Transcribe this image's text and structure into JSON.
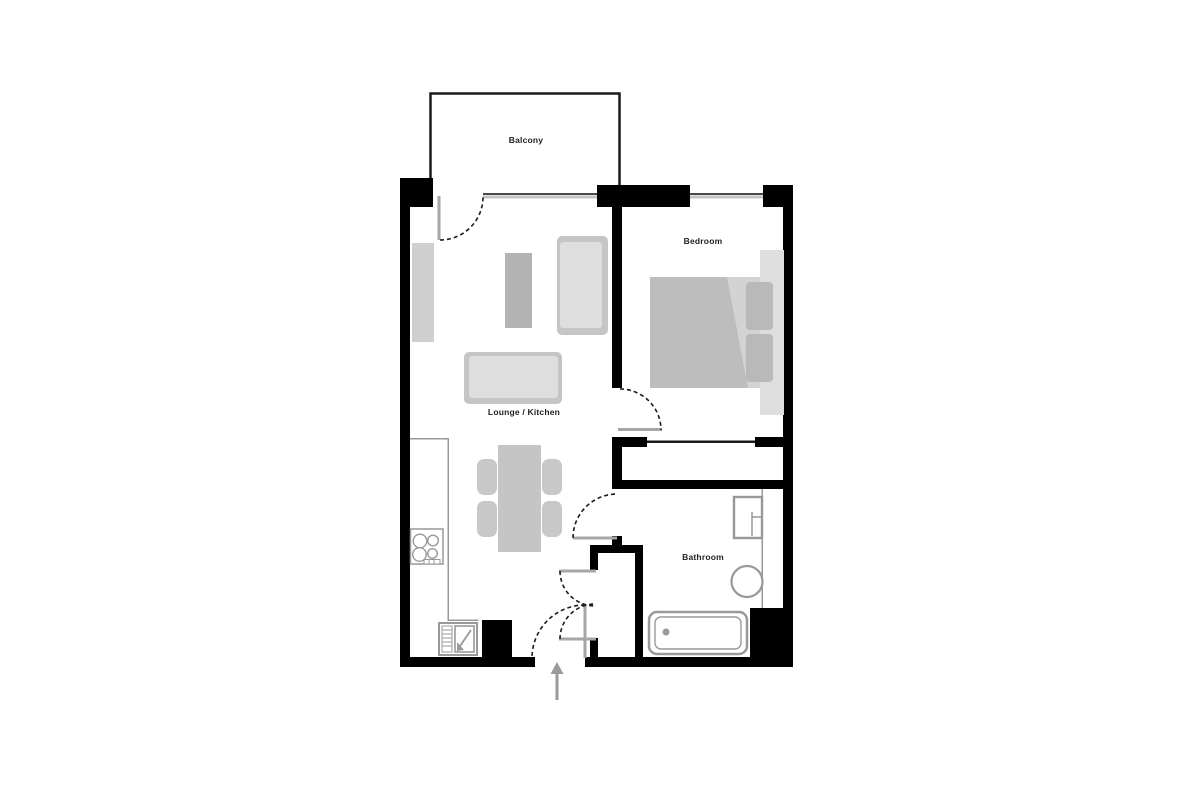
{
  "plan": {
    "type": "apartment-floor-plan",
    "rooms": [
      {
        "id": "balcony",
        "label": "Balcony"
      },
      {
        "id": "bedroom",
        "label": "Bedroom"
      },
      {
        "id": "lounge-kitchen",
        "label": "Lounge / Kitchen"
      },
      {
        "id": "bathroom",
        "label": "Bathroom"
      }
    ],
    "colors": {
      "wall": "#000000",
      "outline": "#1a1a1a",
      "window_dark": "#4a4a4a",
      "window_light": "#c4c4c4",
      "door": "#a6a6a6",
      "counter_line": "#999999",
      "fixture_stroke": "#999999",
      "furniture_light": "#dedede",
      "furniture_mid": "#c5c5c5",
      "furniture_dark": "#b3b3b3",
      "bed_sheet": "#d3d3d3",
      "bed_duvet": "#bdbdbd",
      "arrow": "#9a9a9a",
      "text": "#1f1f1f"
    }
  }
}
